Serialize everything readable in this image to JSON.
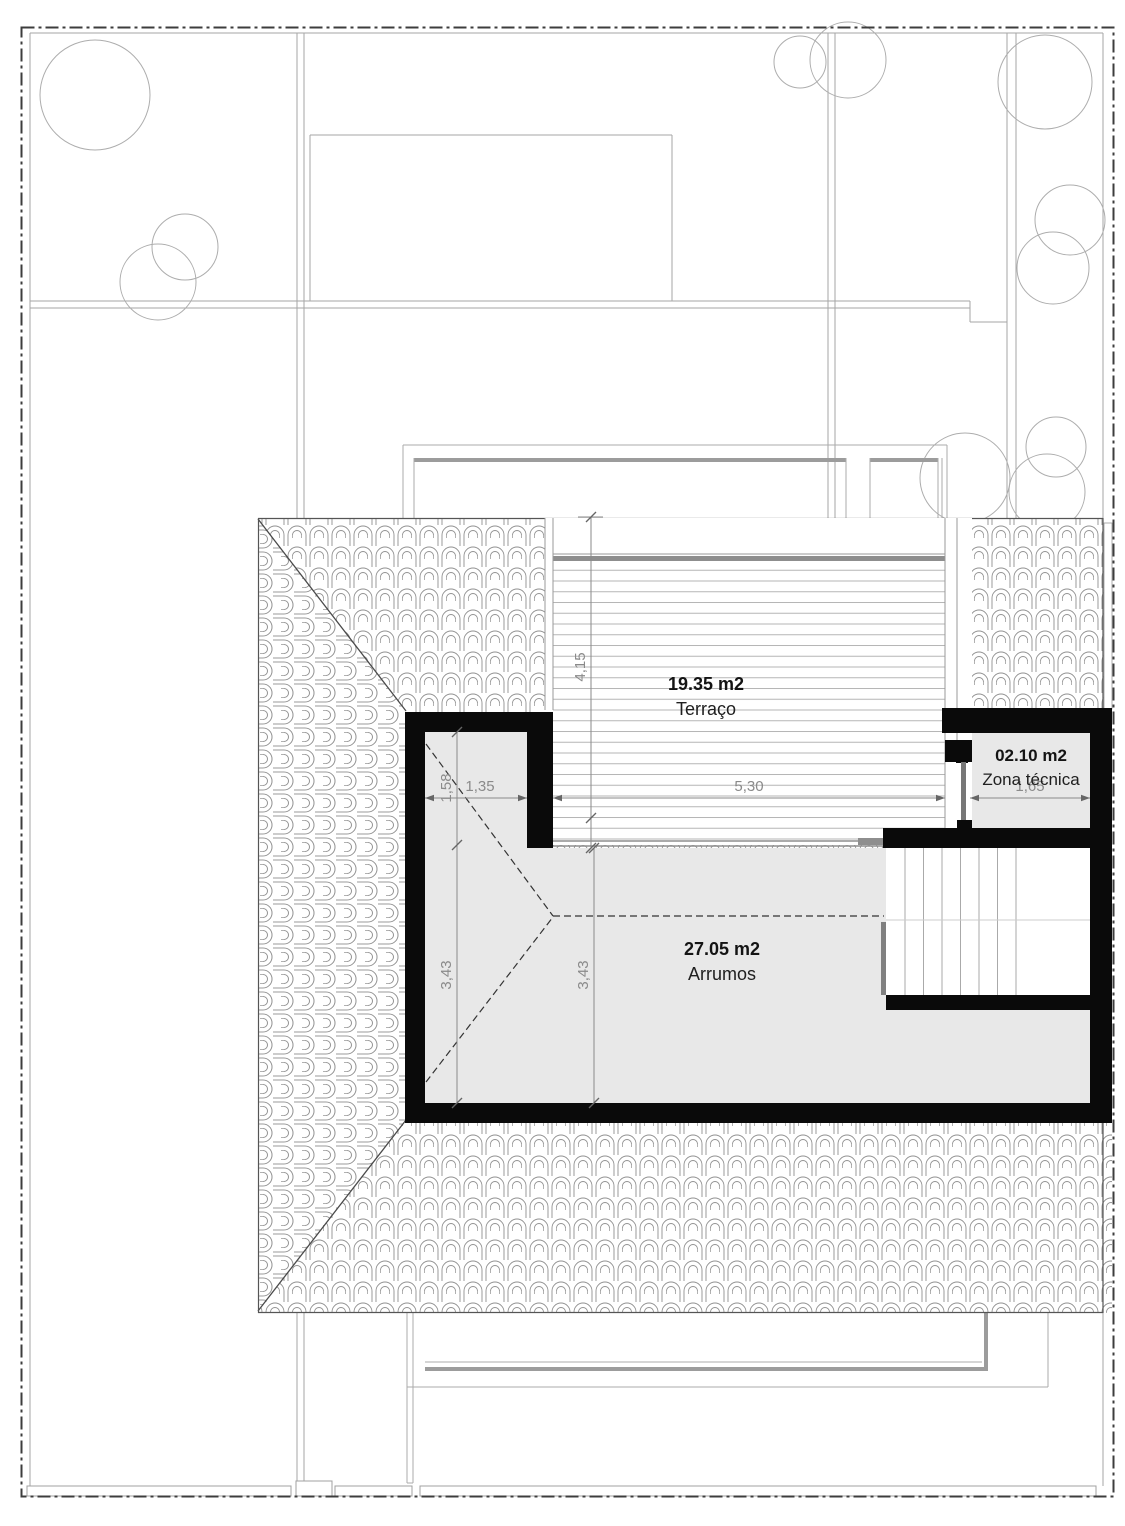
{
  "rooms": [
    {
      "area": "19.35 m2",
      "name": "Terraço"
    },
    {
      "area": "02.10 m2",
      "name": "Zona técnica"
    },
    {
      "area": "27.05 m2",
      "name": "Arrumos"
    }
  ],
  "dimensions": {
    "terrace_height": "4,15",
    "terrace_width": "5,30",
    "technical_width": "1,65",
    "storage_nook_width": "1,35",
    "storage_nook_height": "1,58",
    "storage_height_left": "3,43",
    "storage_height_mid": "3,43"
  },
  "colors": {
    "wall": "#0a0a0a",
    "floor": "#e8e8e8",
    "tile_hatch_line": "#909090",
    "site_line": "#a6a6a6",
    "dimension_line": "#888888",
    "dimension_text": "#8a8a8a",
    "boundary_dash": "#3d3d3d",
    "deck_line": "#b5b5b5"
  }
}
